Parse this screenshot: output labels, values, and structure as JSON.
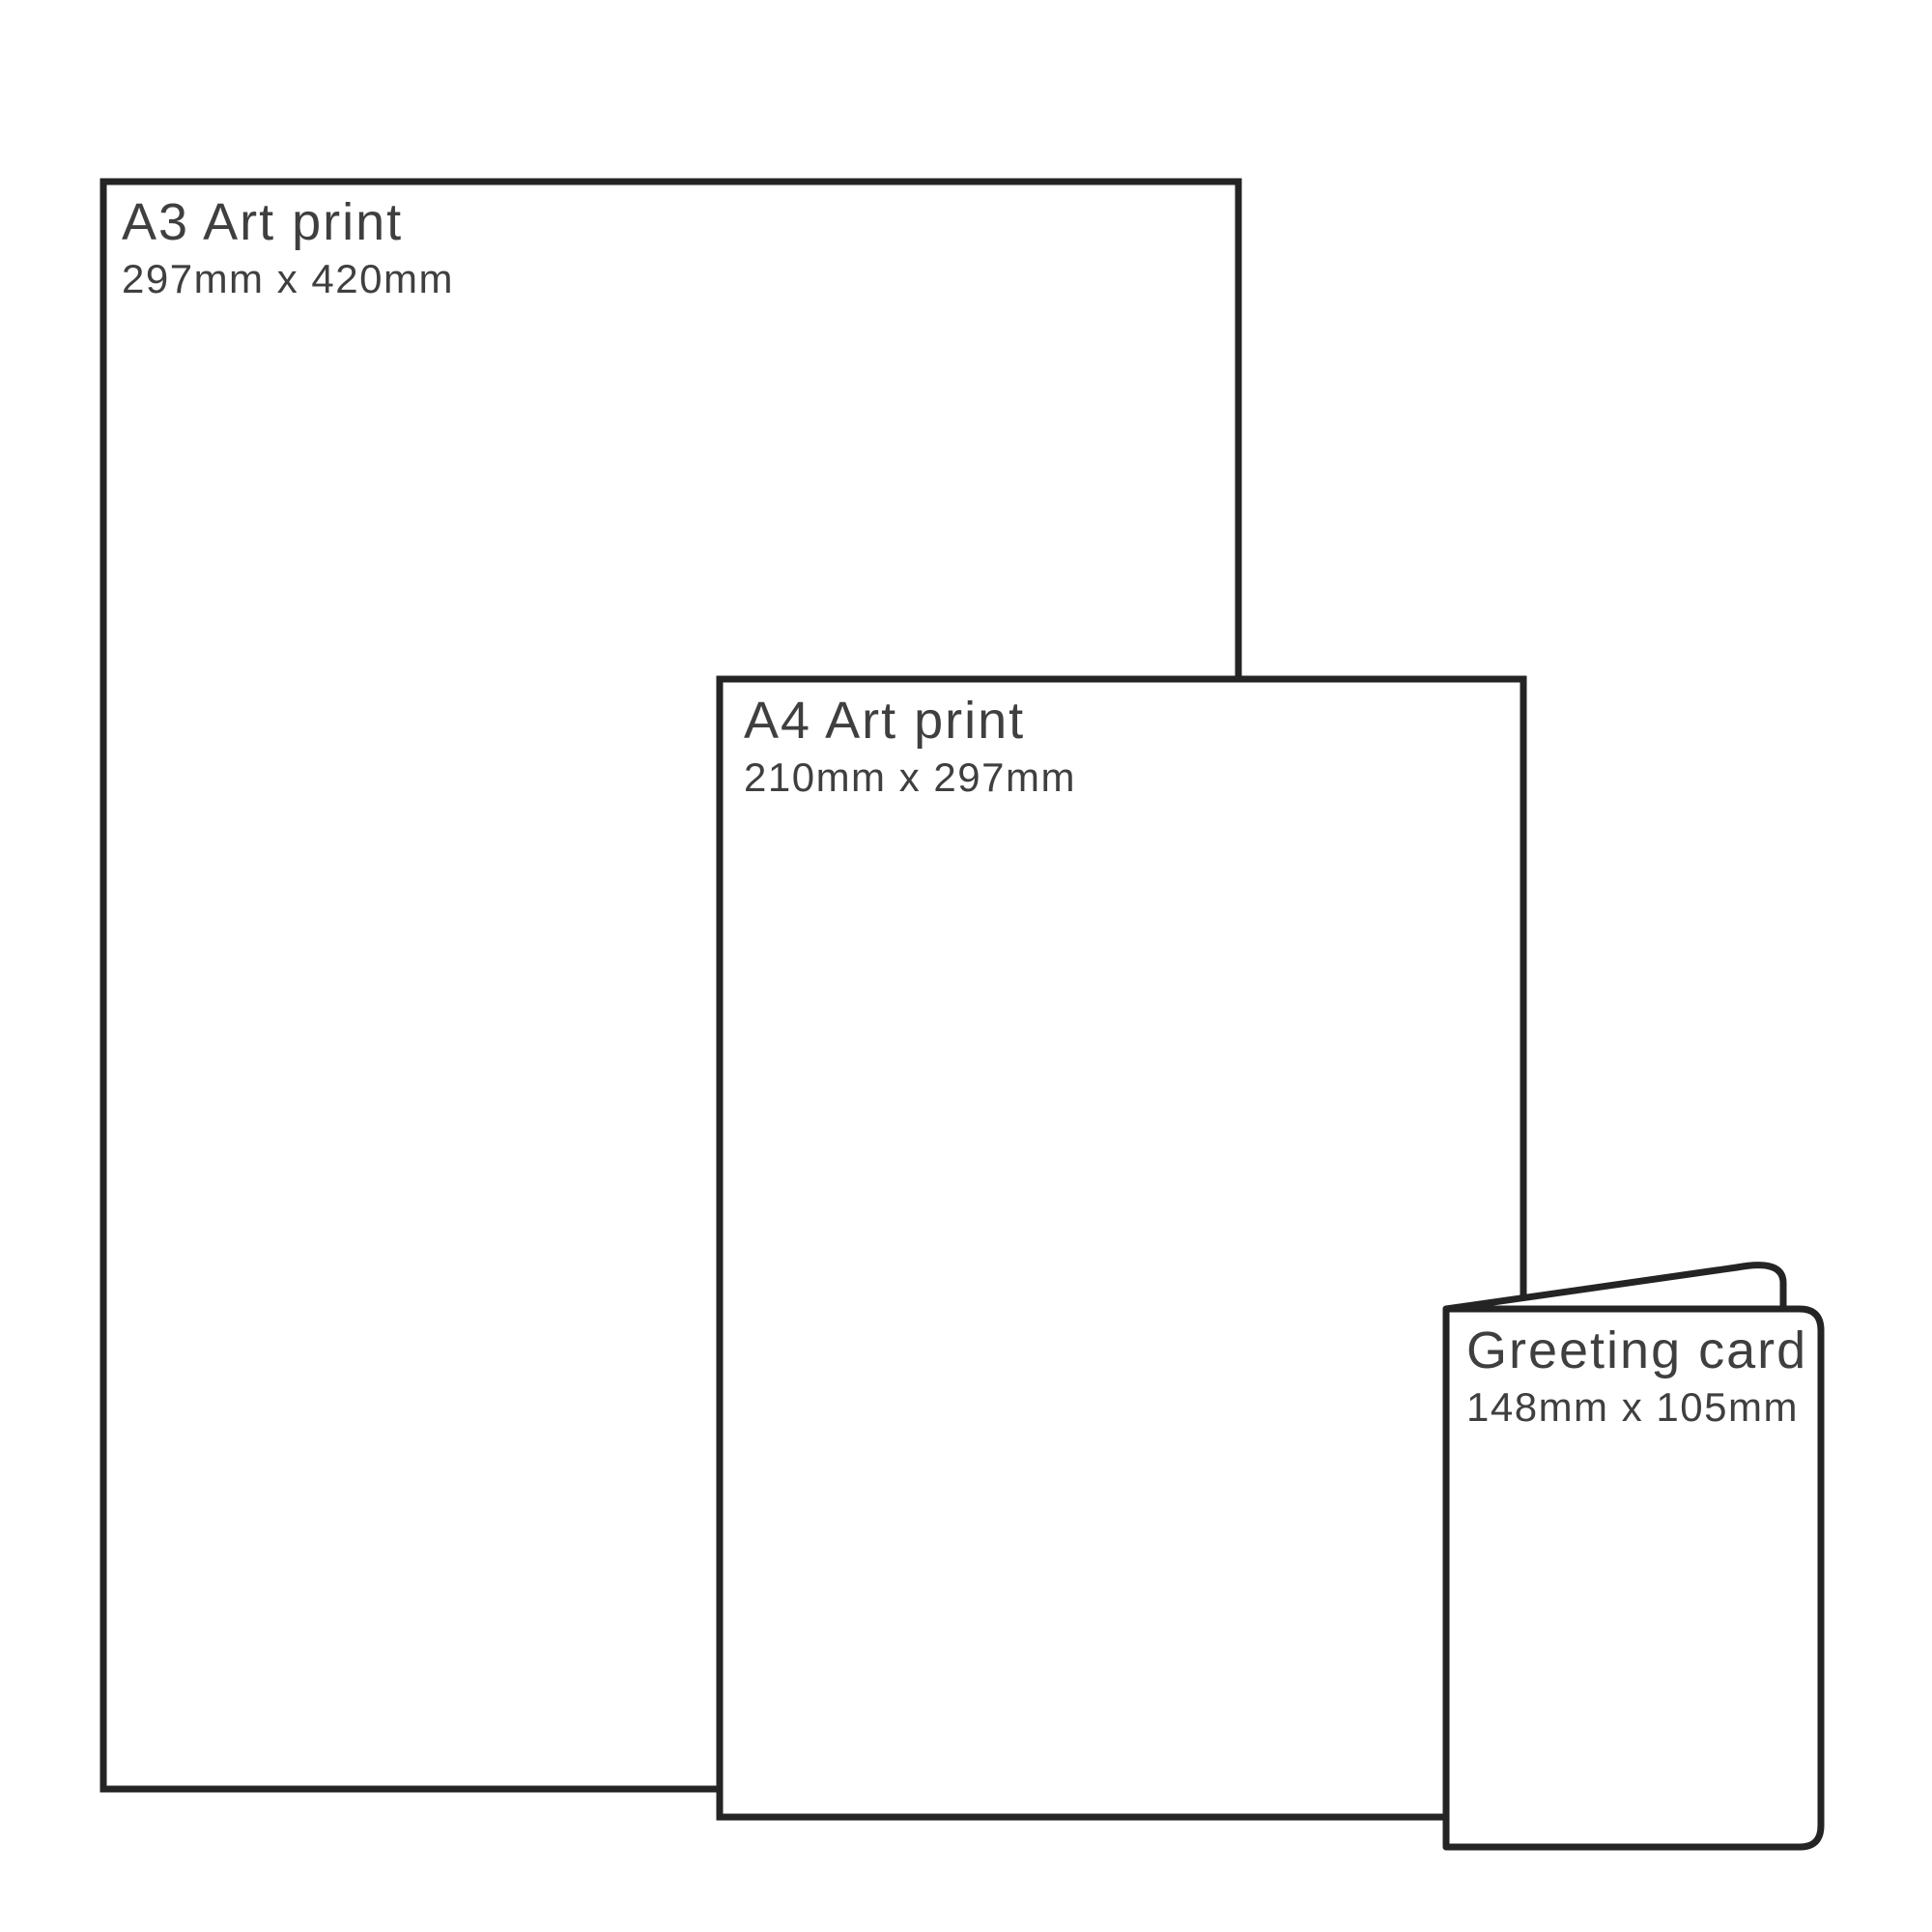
{
  "page": {
    "background_color": "#ffffff",
    "outline_color": "#242424",
    "text_color": "#3f3f3f",
    "fill_color": "#ffffff"
  },
  "products": [
    {
      "title": "A3 Art print",
      "dimensions": "297mm x 420mm"
    },
    {
      "title": "A4 Art print",
      "dimensions": "210mm x 297mm"
    },
    {
      "title": "Greeting card",
      "dimensions": "148mm x 105mm"
    }
  ]
}
